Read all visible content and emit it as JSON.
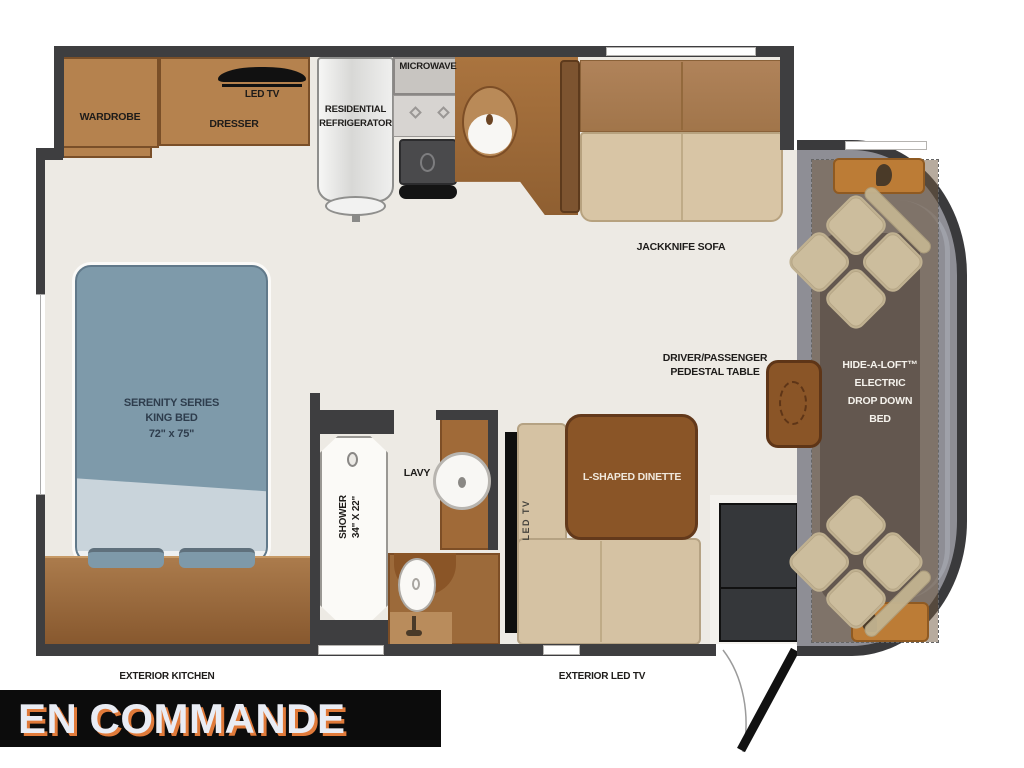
{
  "title_banner": {
    "label": "EN COMMANDE"
  },
  "floorplan": {
    "bedroom": {
      "wardrobe": "WARDROBE",
      "dresser": "DRESSER",
      "led_tv": "LED TV",
      "bed_line1": "SERENITY SERIES",
      "bed_line2": "KING BED",
      "bed_line3": "72\" x 75\""
    },
    "kitchen": {
      "refrigerator_line1": "RESIDENTIAL",
      "refrigerator_line2": "REFRIGERATOR",
      "microwave": "MICROWAVE"
    },
    "bathroom": {
      "shower_line1": "SHOWER",
      "shower_line2": "34\" X 22\"",
      "lavatory": "LAVY"
    },
    "living": {
      "sofa": "JACKKNIFE SOFA",
      "dinette": "L-SHAPED DINETTE",
      "dinette_tv": "LED TV",
      "pedestal_line1": "DRIVER/PASSENGER",
      "pedestal_line2": "PEDESTAL TABLE"
    },
    "cab": {
      "dropdown_bed_line1": "HIDE-A-LOFT™",
      "dropdown_bed_line2": "ELECTRIC",
      "dropdown_bed_line3": "DROP DOWN",
      "dropdown_bed_line4": "BED"
    },
    "exterior": {
      "kitchen": "EXTERIOR KITCHEN",
      "led_tv": "EXTERIOR LED TV"
    }
  },
  "colors": {
    "wall": "#3e3e40",
    "floor": "#edeae4",
    "cabinet_brown": "#b5824e",
    "counter_brown": "#a06a38",
    "sofa_back": "#a87b4d",
    "sofa_seat": "#d8c5a5",
    "bed_blue": "#7e9aaa",
    "table_brown": "#8a5527",
    "cab_gray": "#8e8e95",
    "banner_bg": "#0c0c0c",
    "banner_text": "#e9ecf4",
    "banner_shadow": "#e07a3a"
  }
}
